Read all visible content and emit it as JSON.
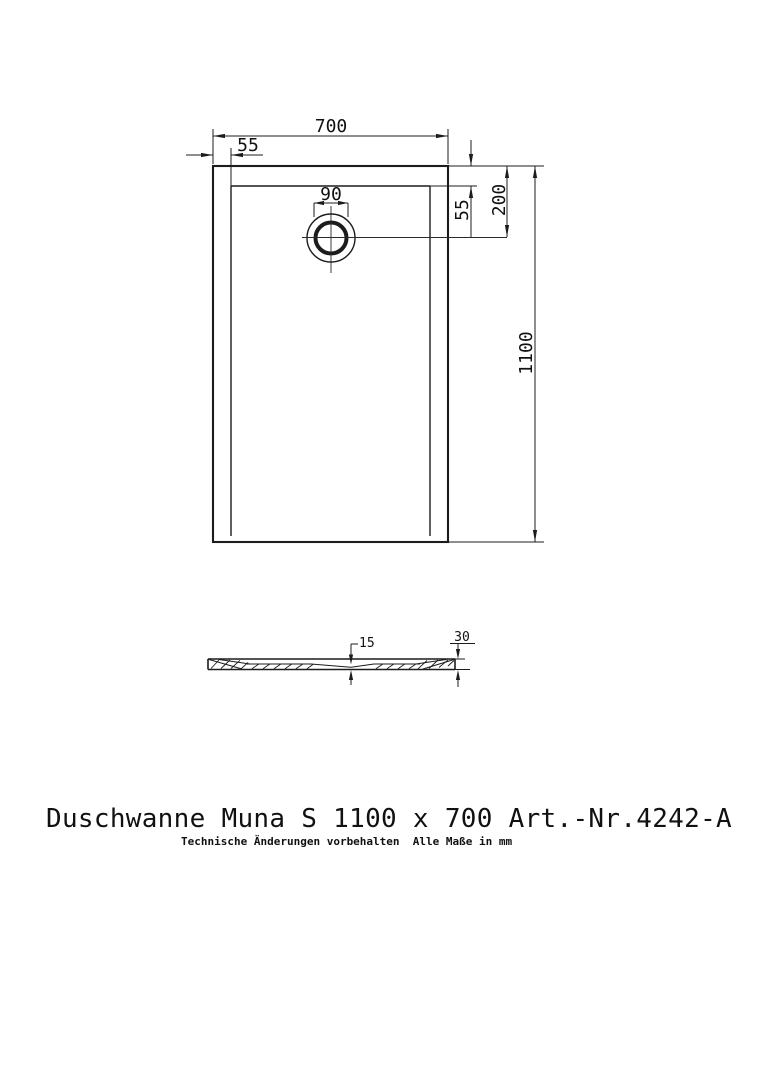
{
  "page": {
    "title": "Duschwanne Muna S 1100 x 700 Art.-Nr.4242-A",
    "subtitle": "Technische Änderungen vorbehalten  Alle Maße in mm"
  },
  "plan_view": {
    "dim_width": "700",
    "dim_rim_left": "55",
    "dim_drain_diameter": "90",
    "dim_rim_top": "55",
    "dim_drain_center_from_top": "200",
    "dim_length": "1100"
  },
  "section_view": {
    "dim_floor_thickness": "15",
    "dim_edge_height": "30"
  },
  "colors": {
    "line": "#1c1c1c",
    "background": "#ffffff"
  }
}
